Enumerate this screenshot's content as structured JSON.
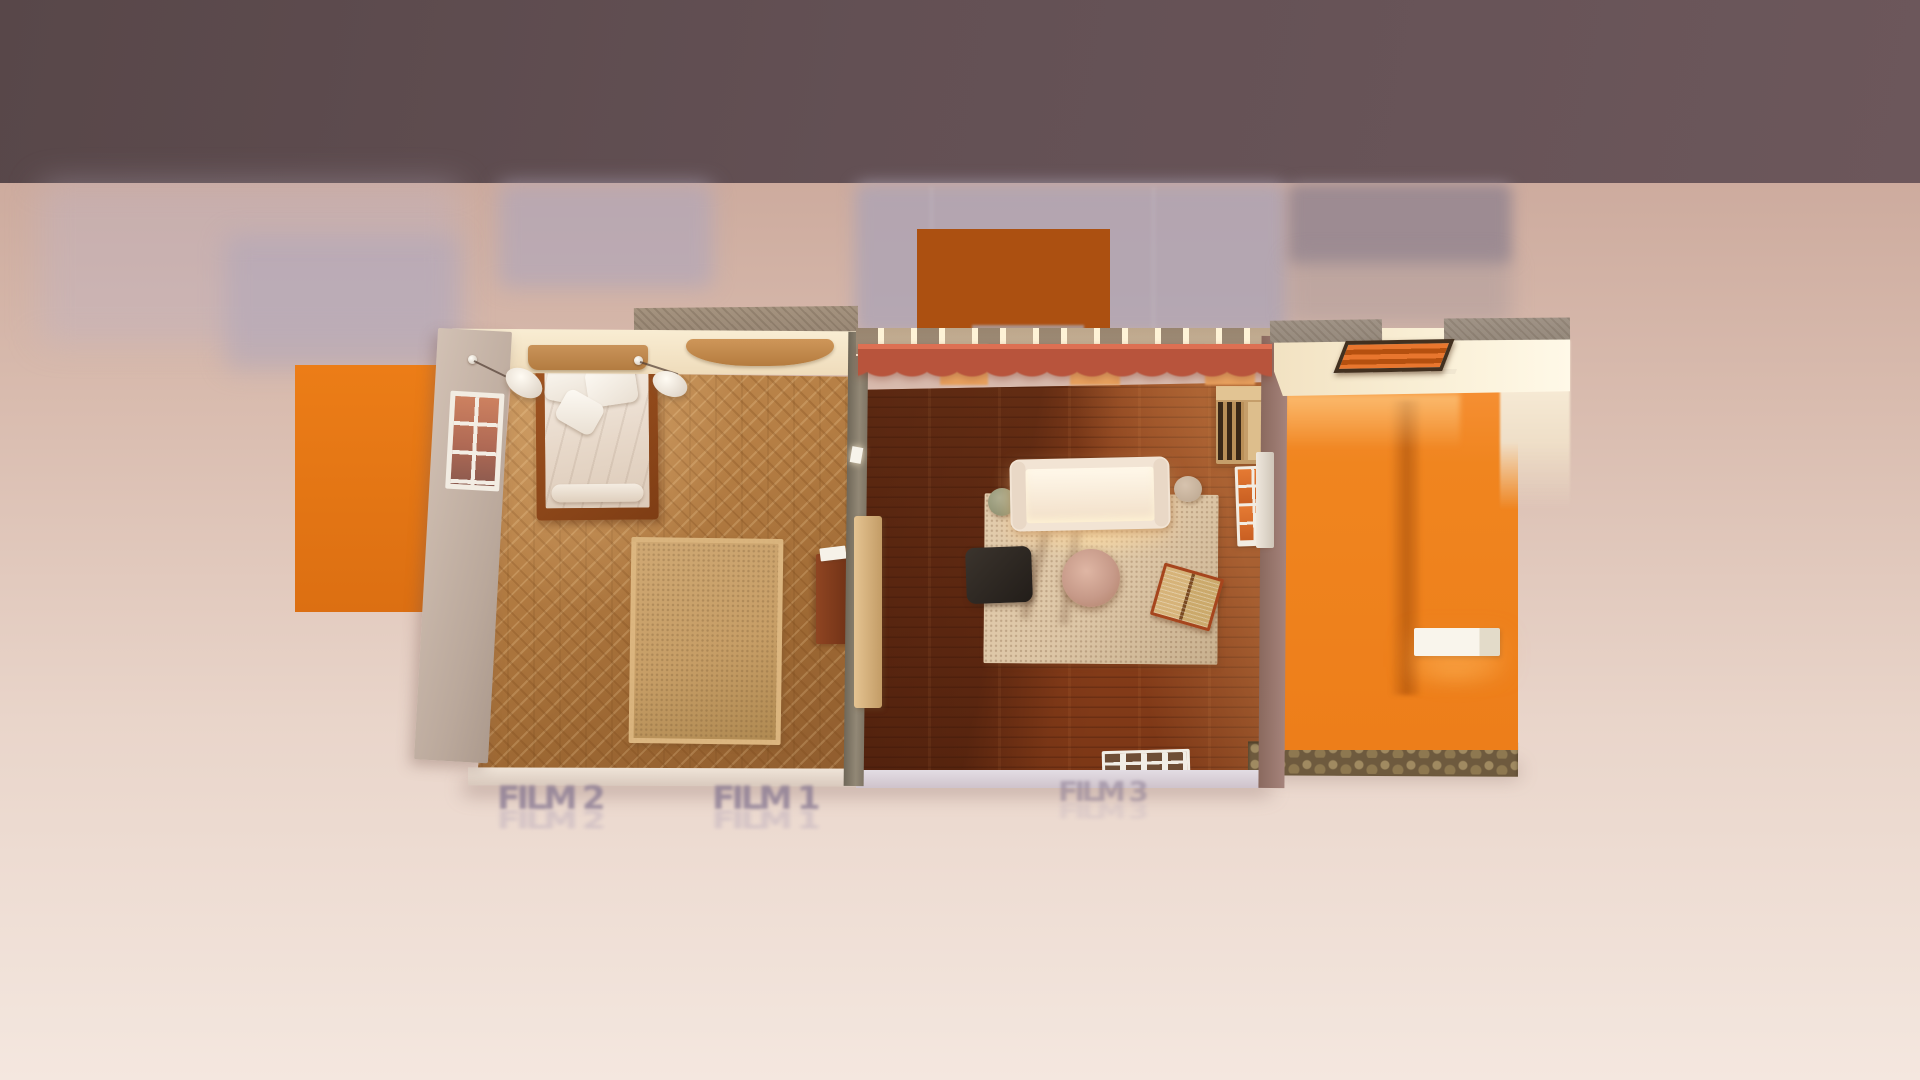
{
  "scene": {
    "type": "3d-render-top-down",
    "title": "Miniature film-set apartment, top-down dollhouse view",
    "labels": {
      "film1": "FILM 1",
      "film2": "FILM 2",
      "film3": "FILM 3"
    },
    "rooms": [
      {
        "id": "bedroom",
        "floor": "herringbone-oak-parquet",
        "objects": [
          "double-bed",
          "pillows",
          "duvet",
          "headboard-shelf",
          "arched-dresser-top",
          "wall-lamp-left",
          "wall-lamp-right",
          "exterior-window",
          "area-rug",
          "dark-wood-dresser",
          "book-on-dresser"
        ]
      },
      {
        "id": "living-room",
        "floor": "dark-walnut-planks",
        "objects": [
          "sofa",
          "coffee-table",
          "side-table",
          "stool",
          "dark-ottoman",
          "area-rug",
          "open-book",
          "bookshelf",
          "wall-frames",
          "red-curtains",
          "curtain-rail-window",
          "doormat",
          "wardrobe-panel",
          "wall-switch"
        ]
      },
      {
        "id": "hallway",
        "floor": "cobblestone",
        "objects": [
          "front-door",
          "door-sill",
          "orange-wall",
          "wall-bench",
          "ceiling-overhang",
          "roof-slabs"
        ]
      }
    ],
    "backdrop": {
      "panels": [
        "orange-panel-left",
        "orange-panel-top"
      ],
      "soft_shadow_patches": 6,
      "seam_lines": 2
    },
    "palette": {
      "top_band": "#645054",
      "ground_top": "#CDAB9E",
      "ground_bottom": "#F4E7DF",
      "accent_orange": "#EC7D17",
      "burnt_orange": "#AC5011",
      "hall_orange": "#F0851F",
      "curtain_red": "#DD7053",
      "bedroom_floor": "#B57E44",
      "living_floor": "#8A3F1B",
      "shadow_blue_gray": "#ACA3B3",
      "cream_wall": "#F8ECD4"
    }
  }
}
